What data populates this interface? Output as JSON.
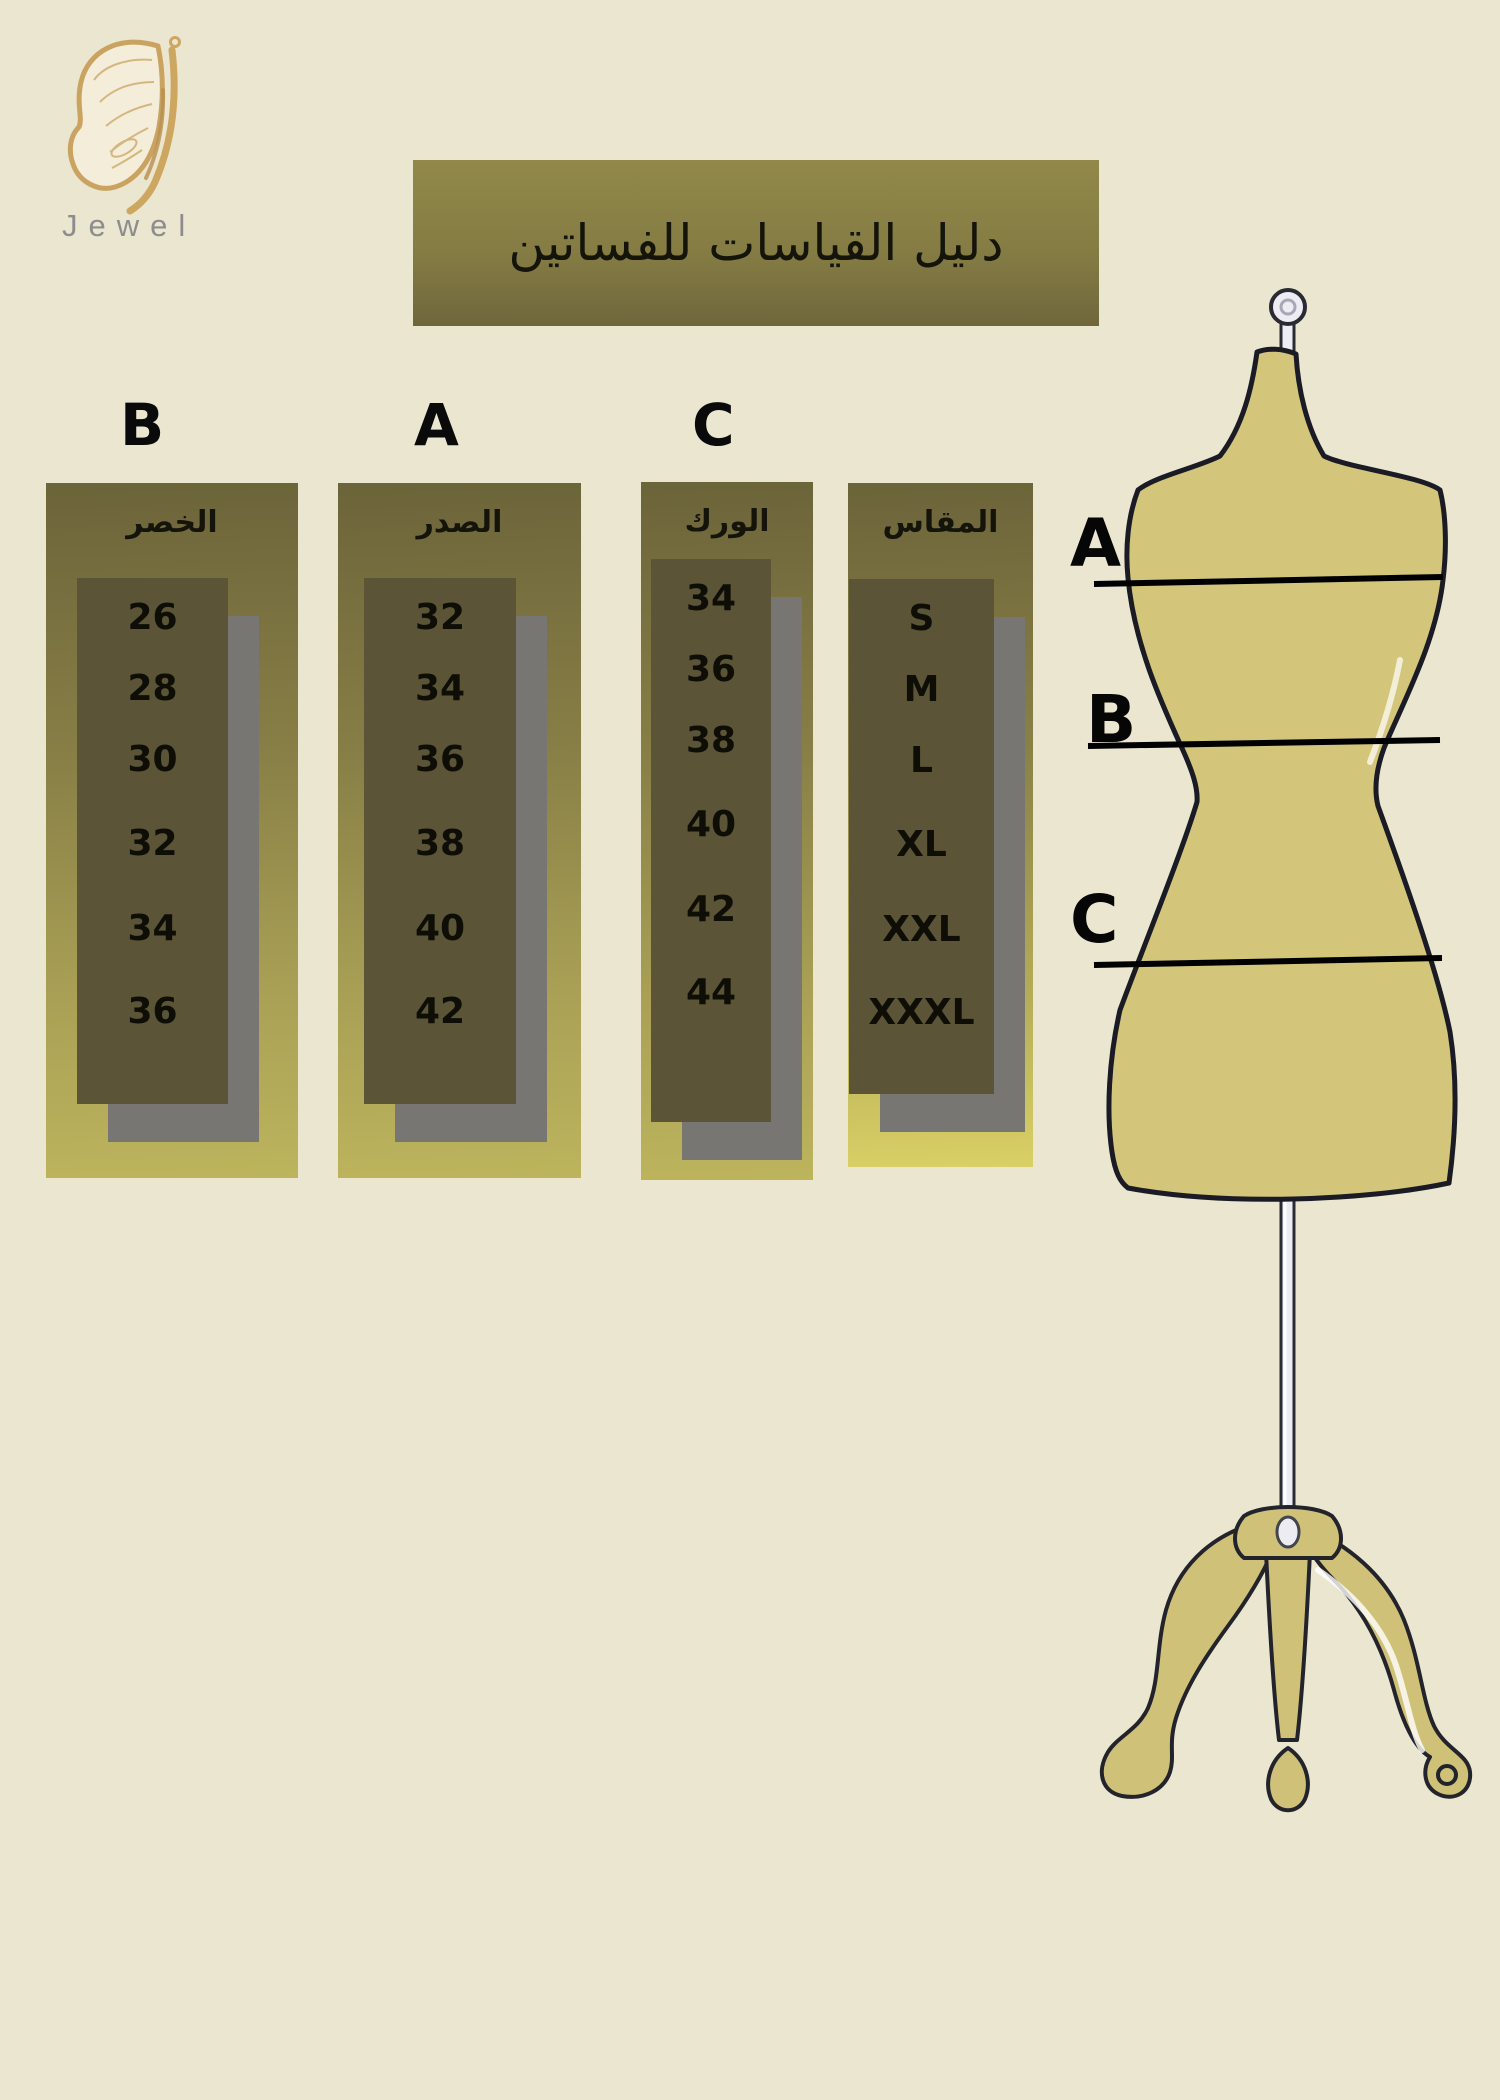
{
  "brand": {
    "name": "Jewel",
    "logo_icon": "butterfly-wing-icon"
  },
  "title": "دليل القياسات للفساتين",
  "size_guide": {
    "columns": [
      {
        "letter": "B",
        "header": "الخصر",
        "values": [
          "26",
          "28",
          "30",
          "32",
          "34",
          "36"
        ]
      },
      {
        "letter": "A",
        "header": "الصدر",
        "values": [
          "32",
          "34",
          "36",
          "38",
          "40",
          "42"
        ]
      },
      {
        "letter": "C",
        "header": "الورك",
        "values": [
          "34",
          "36",
          "38",
          "40",
          "42",
          "44"
        ]
      },
      {
        "letter": "",
        "header": "المقاس",
        "values": [
          "S",
          "M",
          "L",
          "XL",
          "XXL",
          "XXXL"
        ]
      }
    ]
  },
  "mannequin": {
    "labels": {
      "bust": "A",
      "waist": "B",
      "hip": "C"
    }
  },
  "colors": {
    "background": "#ebe6d0",
    "banner_olive": "#857c44",
    "panel_gradient_top": "#6c643a",
    "panel_gradient_bottom": "#bdb45d",
    "values_box": "#5b5436",
    "shadow_gray": "#787672",
    "mannequin_fill": "#d3c67b",
    "logo_gold": "#c9a35f",
    "logo_text_gray": "#8d8d8d"
  },
  "chart_data": {
    "type": "table",
    "title": "دليل القياسات للفساتين",
    "columns": [
      "المقاس",
      "A — الصدر",
      "B — الخصر",
      "C — الورك"
    ],
    "rows": [
      [
        "S",
        32,
        26,
        34
      ],
      [
        "M",
        34,
        28,
        36
      ],
      [
        "L",
        36,
        30,
        38
      ],
      [
        "XL",
        38,
        32,
        40
      ],
      [
        "XXL",
        40,
        34,
        42
      ],
      [
        "XXXL",
        42,
        36,
        44
      ]
    ],
    "layout": "A, B and C measurement lines are drawn across the bust, waist and hip of a dress-form illustration on the right"
  }
}
